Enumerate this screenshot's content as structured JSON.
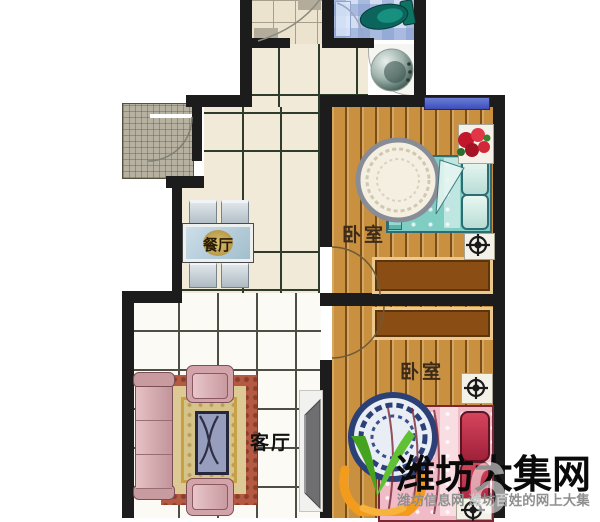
{
  "plan": {
    "type": "apartment-floor-plan",
    "rooms": {
      "dining": {
        "label": "餐厅"
      },
      "living": {
        "label": "客厅"
      },
      "bedroom_top": {
        "label": "卧室"
      },
      "bedroom_bottom": {
        "label": "卧室"
      }
    },
    "palette": {
      "wall": "#1c1c1c",
      "wood_floor": "#c9913f",
      "hall_tile": "#f1ead8",
      "living_tile": "#fbfaf5",
      "bathroom_tile": "#d4def2",
      "window_blue": "#4f62cc",
      "bed_teal": "#80cdc3",
      "bed_pink": "#f0bac6",
      "toilet_green": "#0b655c",
      "rug_red": "#b45a42",
      "rug_gold": "#dcc994",
      "sofa_pink": "#d7a9ad"
    },
    "icons": {
      "toilet": "toilet-top-view-icon",
      "washing_machine": "washing-machine-top-view-icon",
      "ac_unit": "compass-cross-marker-icon",
      "flower": "potted-flower-icon",
      "door": "door-swing-arc"
    }
  },
  "watermark": {
    "site_name": "潍坊大集网",
    "tagline": "潍坊信息网 潍坊百姓的网上大集",
    "ghost_glyph": "6",
    "logo": "sprout-v-leaf-logo",
    "colors": {
      "green": "#56b32a",
      "orange": "#f29b1d",
      "title": "#0a0a0a",
      "tagline": "#8f8f8f"
    }
  }
}
